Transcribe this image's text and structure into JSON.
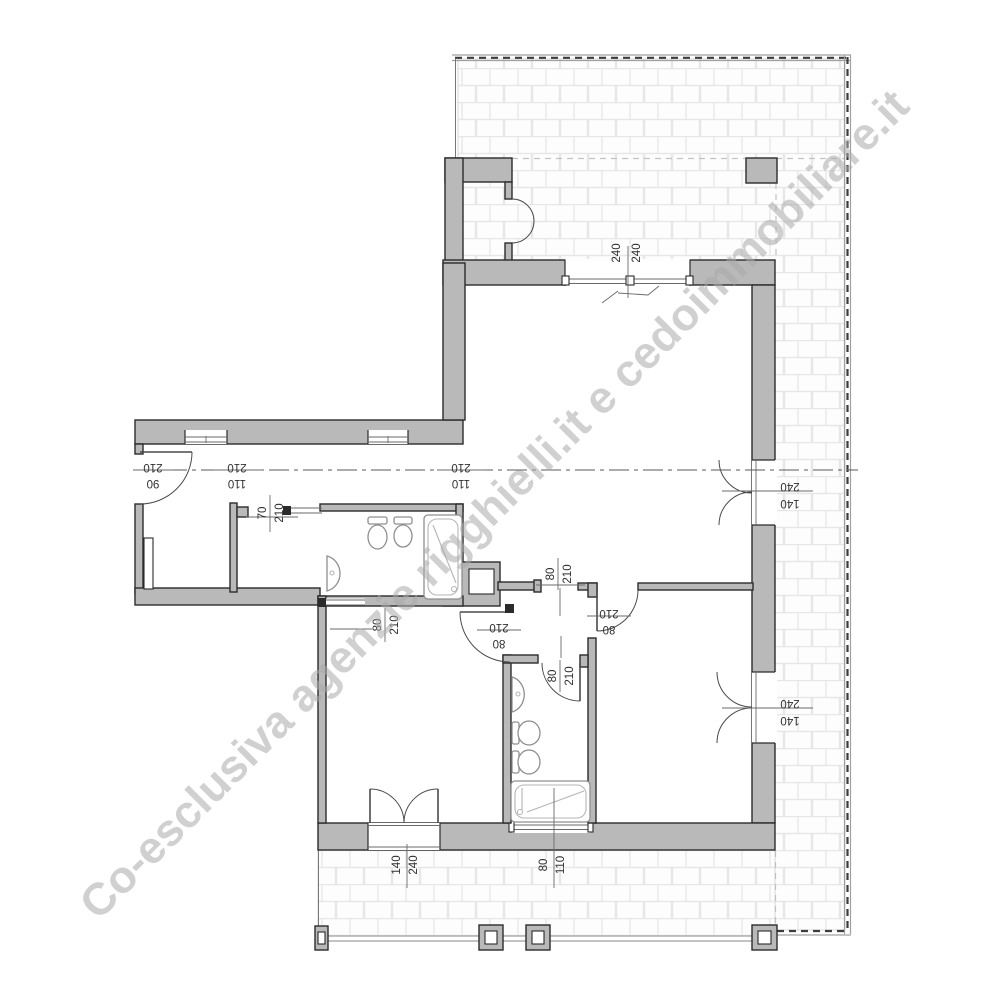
{
  "watermark": {
    "text": "Co-esclusiva agenzie rigghielli.it e cedoimmobiliare.it",
    "color": "#a9a9a9"
  },
  "colors": {
    "wall_fill": "#b9b9b9",
    "wall_line": "#2b2b2b",
    "brick_line": "#e7e7e7",
    "dim_text": "#303030"
  },
  "dims": {
    "entry_door": {
      "a": "210",
      "b": "90"
    },
    "hall_window_a": {
      "a": "210",
      "b": "110"
    },
    "hall_window_b": {
      "a": "210",
      "b": "110"
    },
    "closet_door": {
      "a": "70",
      "b": "210"
    },
    "living_terrace_window": {
      "a": "240",
      "b": "240"
    },
    "living_hall_opening": {
      "a": "80",
      "b": "210"
    },
    "bedroom1_hall_door": {
      "a": "210",
      "b": "80"
    },
    "bedroom2_door": {
      "a": "210",
      "b": "80"
    },
    "bathroom2_door": {
      "a": "80",
      "b": "210"
    },
    "bedroom1_sliding_door": {
      "a": "80",
      "b": "210"
    },
    "french_door_upper": {
      "a": "240",
      "b": "140"
    },
    "french_door_lower": {
      "a": "240",
      "b": "140"
    },
    "bedroom1_french_door": {
      "a": "140",
      "b": "240"
    },
    "bathroom2_window": {
      "a": "80",
      "b": "110"
    }
  },
  "fixture_icons": [
    "toilet-icon",
    "bidet-icon",
    "sink-icon",
    "bathtub-icon"
  ],
  "areas": [
    "terrace",
    "living-room",
    "hall",
    "bathroom-1",
    "bathroom-2",
    "bedroom-1",
    "bedroom-2",
    "balcony"
  ]
}
